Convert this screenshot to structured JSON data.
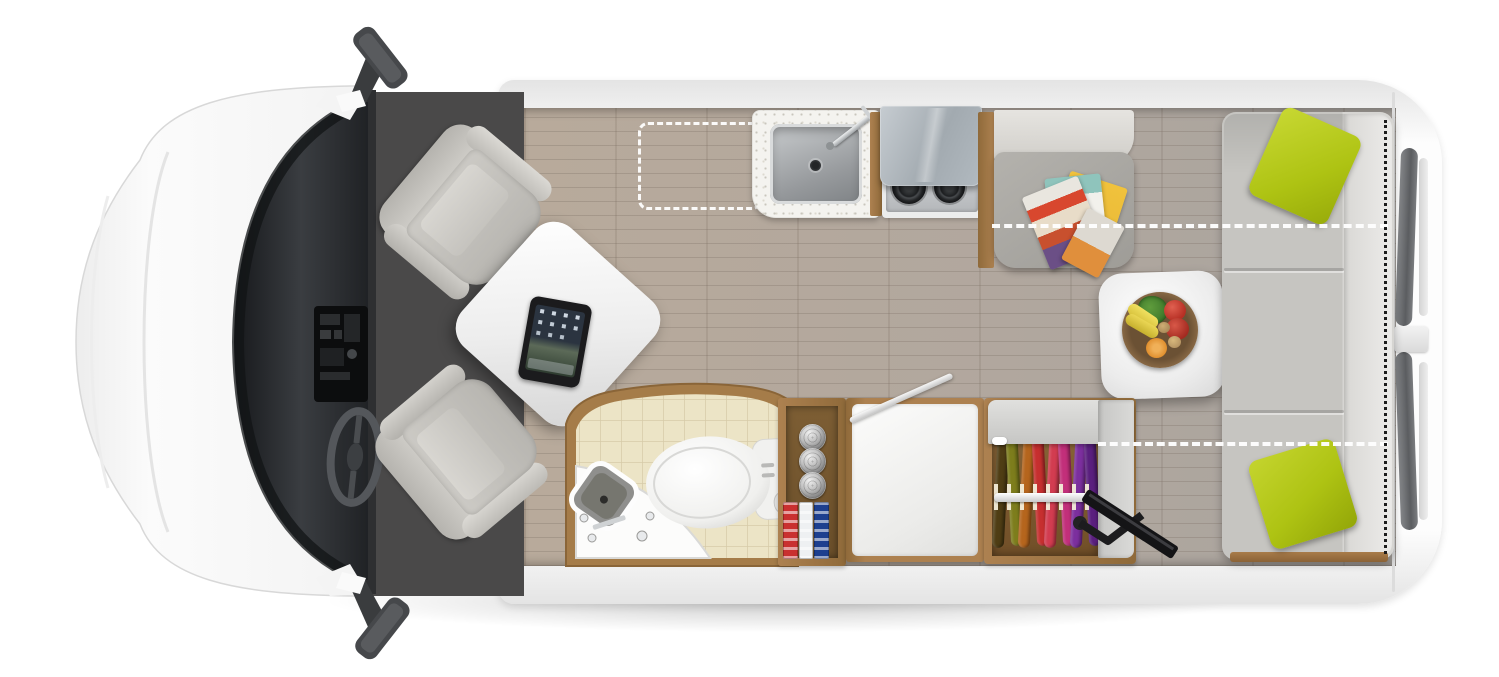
{
  "scene": {
    "name": "rv-camper-van-floorplan-top-view",
    "description_items": [
      "van-cab-with-windshield-dashboard-steering-wheel",
      "two-swivel-captain-chairs",
      "front-table-with-tablet",
      "kitchen-sink-and-two-burner-stove-with-lid",
      "roof-vent-dashed-outline",
      "dinette-bench-with-magazines",
      "pedestal-table-with-fruit-bowl",
      "rear-sofa-bed-with-two-lime-pillows",
      "bed-conversion-dashed-lines",
      "bathroom-with-toilet-and-corner-sink",
      "pantry-with-cans-and-boxes",
      "counter-with-flip-up-extension",
      "wardrobe-with-hanging-clothes",
      "swivel-tv-mount",
      "rear-doors-with-windows",
      "side-mirrors"
    ]
  },
  "palette": {
    "body": "#fdfdfd",
    "body-edge": "#e4e4e4",
    "carpet": "#4a4949",
    "floor": "#b3a89d",
    "wood": "#ad8150",
    "wood-interior": "#8a6638",
    "tile": "#ece4c6",
    "tile-line": "#d6cba8",
    "counter": "#f4f3ef",
    "steel": "#96999c",
    "lid": "#a2aab0",
    "seat-gray": "#9e9c97",
    "seat-light": "#cfcdc8",
    "sofa": "#c6c5c1",
    "sofa-light": "#ecebe9",
    "pillow": "#aec313",
    "magazine-red": "#d8472e",
    "magazine-yellow": "#e9b836",
    "fruit-bowl": "#8a6a46",
    "fruit-green": "#3f7a2c",
    "fruit-red": "#b62f24",
    "fruit-yellow": "#d8c23c",
    "fruit-orange": "#e08f2e",
    "cabinet-gray": "#c6c6c4",
    "can": "#c2c2c2",
    "tv": "#151517",
    "dashed-white": "#ffffff",
    "dotted-black": "#1c1c1c"
  },
  "wardrobe": {
    "clothes_colors": [
      "#4f3d14",
      "#7d7d1c",
      "#b5651d",
      "#c62f2f",
      "#d23c50",
      "#c22f7a",
      "#7c2f9e",
      "#5a1f7e"
    ]
  },
  "pantry": {
    "cans_count": 3,
    "box_colors": [
      "#c93030",
      "#eef0f2",
      "#1d3f8f"
    ]
  },
  "sofa": {
    "pillow_count": 2
  },
  "stove": {
    "burner_count": 2
  },
  "chairs": {
    "count": 2
  }
}
